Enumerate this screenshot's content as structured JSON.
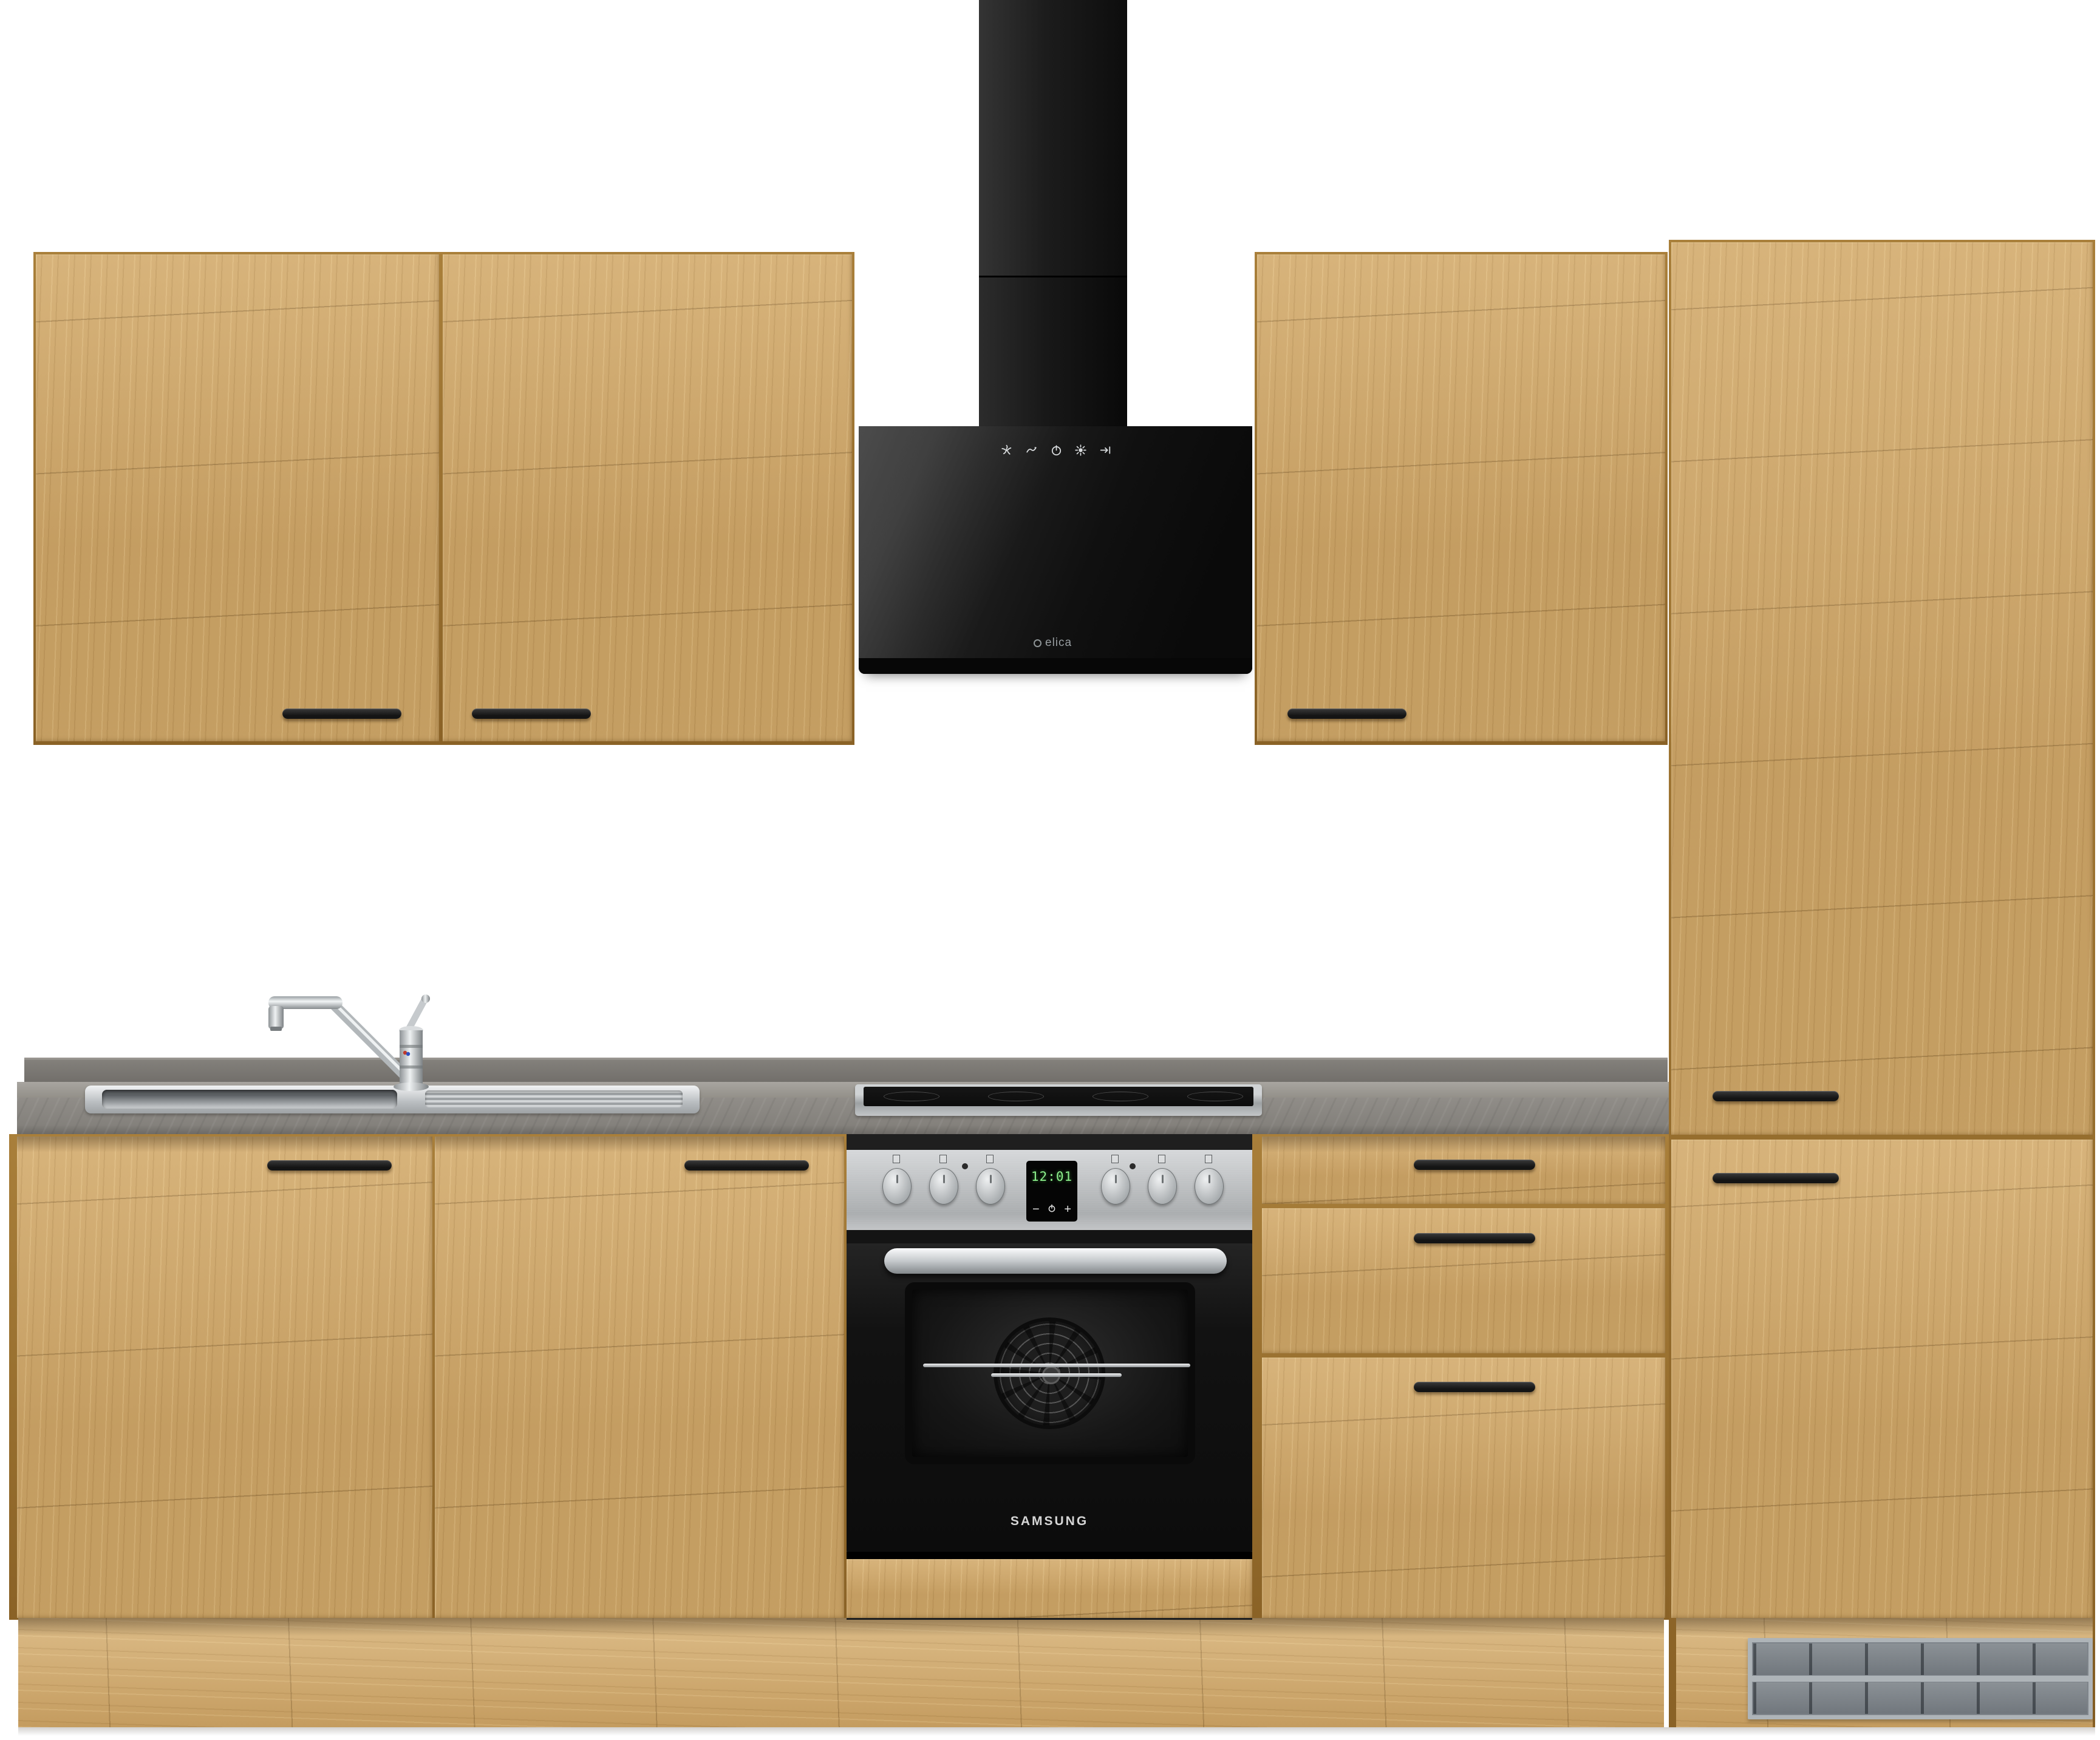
{
  "scene": {
    "type": "product-photo",
    "subject": "oak kitchen cabinet set with appliances",
    "background_color": "#ffffff"
  },
  "cabinets": {
    "front_color": "#cda465",
    "carcass_color": "#8a6226",
    "wall_left_doors": 2,
    "wall_right_doors": 1,
    "base_doors": 2,
    "drawers": 3,
    "tall_doors": 2,
    "handle_color": "#1c1c1c"
  },
  "countertop": {
    "color": "#8b8883",
    "style": "concrete-look",
    "upstand": true
  },
  "sink": {
    "material_color": "#c7cacd",
    "bowls": 1,
    "drainer": true,
    "faucet": "chrome single-lever"
  },
  "hood": {
    "brand": "elica",
    "color": "#141414",
    "type": "head-free wall hood with chimney",
    "icons": [
      "fan-icon",
      "swirl-icon",
      "power-icon",
      "light-icon",
      "timer-icon"
    ]
  },
  "cooktop": {
    "zones": 4,
    "color": "#101010",
    "frame": "stainless"
  },
  "oven": {
    "brand": "SAMSUNG",
    "display_time": "12:01",
    "button_minus": "−",
    "button_plus": "+",
    "knobs": 6,
    "panel": "stainless"
  },
  "vent_grille": {
    "color": "#8f959a",
    "position": "tall-cabinet plinth"
  }
}
